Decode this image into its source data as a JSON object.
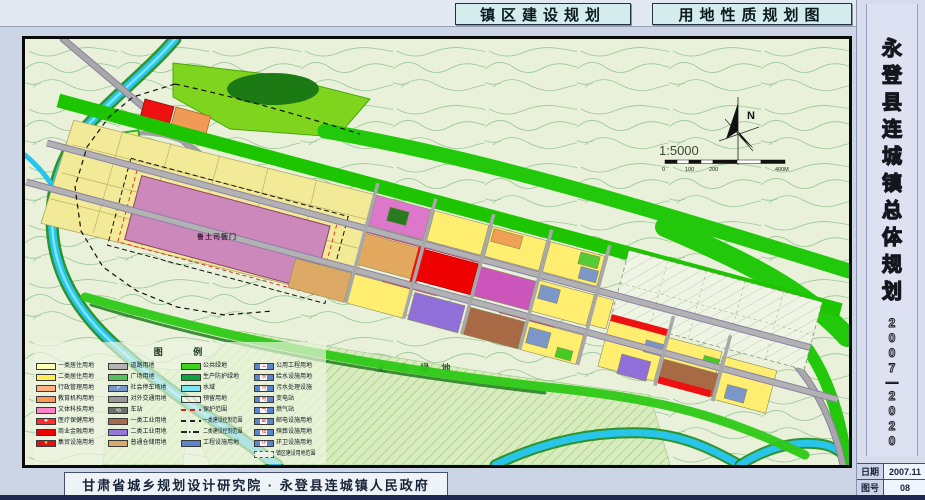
{
  "header": {
    "title_left": "镇区建设规划",
    "title_right": "用地性质规划图"
  },
  "sidebar": {
    "title": "永登县连城镇总体规划",
    "period_top": "2007",
    "period_dash": "—",
    "period_bottom": "2020",
    "rows": [
      {
        "label": "日期",
        "value": "2007.11"
      },
      {
        "label": "图号",
        "value": "08"
      }
    ]
  },
  "footer": {
    "credit": "甘肃省城乡规划设计研究院 · 永登县连城镇人民政府"
  },
  "map": {
    "labels": {
      "north": "N",
      "scale": "1:5000",
      "scale_ticks": [
        "0",
        "100",
        "200",
        "400M"
      ],
      "eco_green": "生 态 绿 地",
      "heritage": "鲁土司衙门"
    },
    "colors": {
      "page_bg": "#ccd5e6",
      "map_bg": "#e9f1da",
      "contour": "#8cc08c",
      "water": "#29c4ea",
      "river_bank": "#1a8a1a",
      "buffer_green": "#22c80a",
      "hill_green": "#7fd41e",
      "road": "#b2b2b2",
      "road_casing": "#8d7fa8"
    }
  },
  "legend": {
    "title": "图 例",
    "columns": [
      [
        {
          "label": "一类居住用地",
          "color": "#ffffb8",
          "type": "fill"
        },
        {
          "label": "二类居住用地",
          "color": "#ffee55",
          "type": "fill"
        },
        {
          "label": "行政管理用地",
          "color": "#ffb385",
          "type": "fill"
        },
        {
          "label": "教育机构用地",
          "color": "#ff9850",
          "type": "fill"
        },
        {
          "label": "文体科技用地",
          "color": "#ff85c8",
          "type": "fill"
        },
        {
          "label": "医疗保健用地",
          "color": "#ff2a2a",
          "type": "fill",
          "symbol": "✚",
          "symbol_color": "#ffffff"
        },
        {
          "label": "商业金融用地",
          "color": "#f00000",
          "type": "fill"
        },
        {
          "label": "集贸设施用地",
          "color": "#e01010",
          "type": "fill",
          "symbol": "★",
          "symbol_color": "#ffe14a"
        }
      ],
      [
        {
          "label": "道路用地",
          "color": "#b5b5b5",
          "type": "fill"
        },
        {
          "label": "广场用地",
          "color": "#58c058",
          "type": "fill"
        },
        {
          "label": "社会停车场地",
          "color": "#7b96c8",
          "type": "fill",
          "symbol": "P",
          "symbol_color": "#ffffff"
        },
        {
          "label": "对外交通用地",
          "color": "#9a9a9a",
          "type": "fill"
        },
        {
          "label": "车站",
          "color": "#6f6f6f",
          "type": "fill",
          "symbol": "站",
          "symbol_color": "#ffffff"
        },
        {
          "label": "一类工业用地",
          "color": "#a86a4a",
          "type": "fill"
        },
        {
          "label": "二类工业用地",
          "color": "#9478d8",
          "type": "fill"
        },
        {
          "label": "普通仓储用地",
          "color": "#dcaa68",
          "type": "fill"
        }
      ],
      [
        {
          "label": "公共绿地",
          "color": "#3ed41e",
          "type": "fill"
        },
        {
          "label": "生产防护绿地",
          "color": "#0ca43c",
          "type": "fill"
        },
        {
          "label": "水域",
          "color": "#7de4f0",
          "type": "fill"
        },
        {
          "label": "预留用地",
          "color": "#eff5e4",
          "type": "hatch"
        },
        {
          "label": "保护范围",
          "color": "#e02020",
          "type": "dashed"
        },
        {
          "label": "一类建设控制范围",
          "color": "#222222",
          "type": "dashed"
        },
        {
          "label": "二类建设控制范围",
          "color": "#222222",
          "type": "dashdot"
        },
        {
          "label": "工程设施用地",
          "color": "#5c86cc",
          "type": "fill"
        }
      ],
      [
        {
          "label": "公用工程用地",
          "color": "#5c86cc",
          "type": "fill",
          "symbol": "工",
          "symbol_color": "#cc2222",
          "chip": true
        },
        {
          "label": "给水设施用地",
          "color": "#5c86cc",
          "type": "fill",
          "symbol": "水",
          "symbol_color": "#cc2222",
          "chip": true
        },
        {
          "label": "污水处理设施",
          "color": "#5c86cc",
          "type": "fill",
          "symbol": "污",
          "symbol_color": "#cc2222",
          "chip": true
        },
        {
          "label": "变电站",
          "color": "#5c86cc",
          "type": "fill",
          "symbol": "电",
          "symbol_color": "#cc2222",
          "chip": true
        },
        {
          "label": "燃气站",
          "color": "#5c86cc",
          "type": "fill",
          "symbol": "气",
          "symbol_color": "#cc2222",
          "chip": true
        },
        {
          "label": "邮电设施用地",
          "color": "#5c86cc",
          "type": "fill",
          "symbol": "邮",
          "symbol_color": "#cc2222",
          "chip": true
        },
        {
          "label": "殡葬设施用地",
          "color": "#5c86cc",
          "type": "fill",
          "symbol": "殡",
          "symbol_color": "#cc2222",
          "chip": true
        },
        {
          "label": "环卫设施用地",
          "color": "#5c86cc",
          "type": "fill",
          "symbol": "环",
          "symbol_color": "#cc2222",
          "chip": true
        },
        {
          "label": "镇区建设用地范围",
          "color": "#44506e",
          "type": "outline"
        }
      ]
    ]
  }
}
